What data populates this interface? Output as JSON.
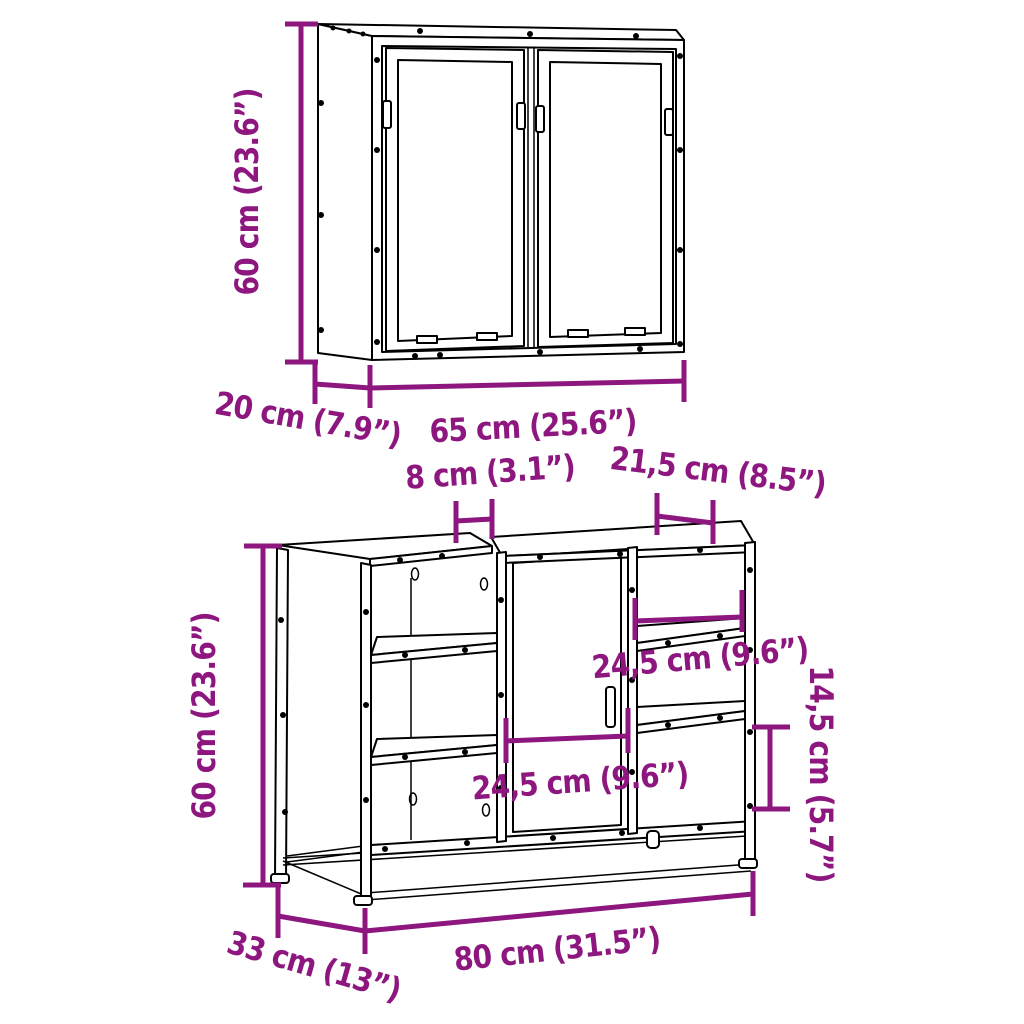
{
  "diagram_type": "furniture dimension drawing, 2-piece bathroom furniture set",
  "colors": {
    "dimension_accent": "#8D177F",
    "line_art": "#000000",
    "background": "#FFFFFF"
  },
  "mirror_cabinet": {
    "item": "wall mirror cabinet with two doors",
    "height_label": "60 cm (23.6”)",
    "depth_label": "20 cm (7.9”)",
    "width_label": "65 cm (25.6”)"
  },
  "sink_cabinet": {
    "item": "bathroom sink cabinet with door, open shelves and metal base frame",
    "height_label": "60 cm (23.6”)",
    "top_notch_label": "8 cm (3.1”)",
    "top_right_opening_label": "21,5 cm (8.5”)",
    "right_shelf_width_label": "24,5 cm (9.6”)",
    "door_width_label": "24,5 cm (9.6”)",
    "right_compartment_height_label": "14,5 cm (5.7”)",
    "width_label": "80 cm (31.5”)",
    "depth_label": "33 cm (13”)"
  }
}
